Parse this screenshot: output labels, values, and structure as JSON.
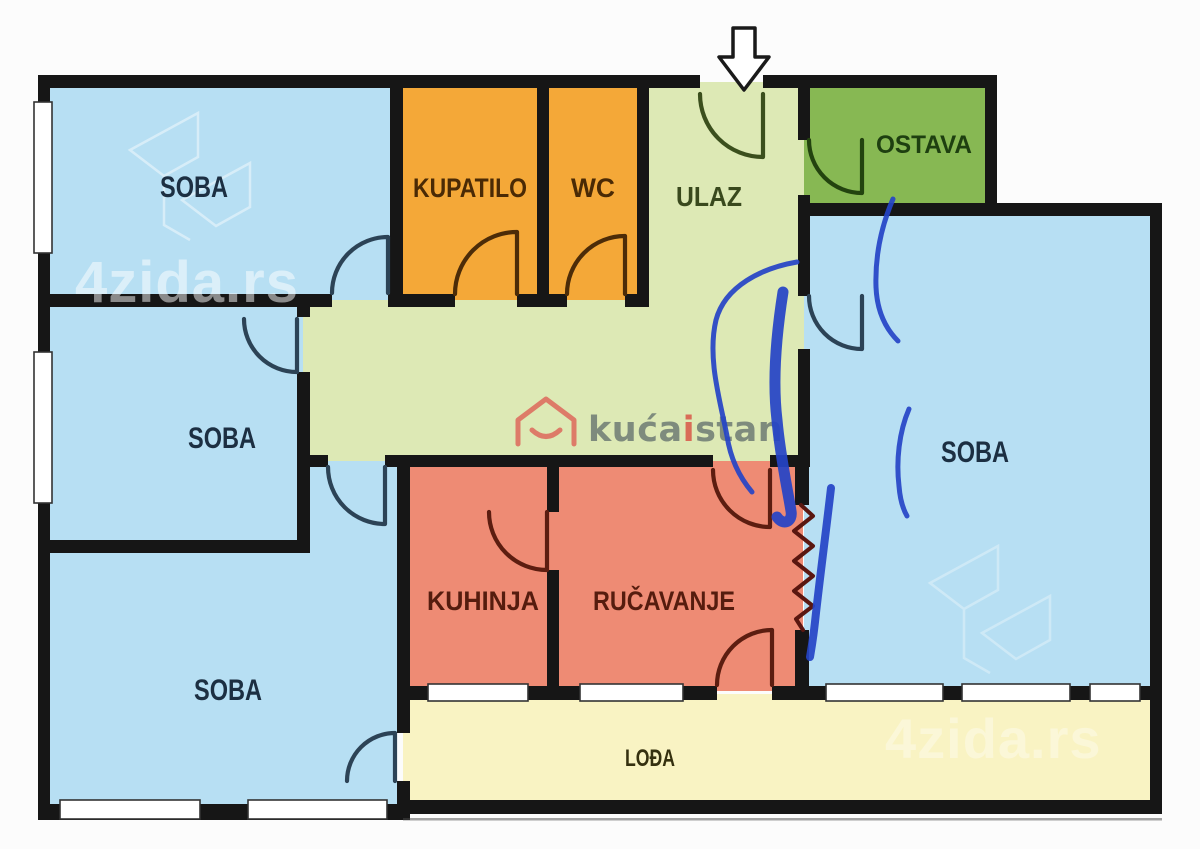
{
  "rooms": {
    "soba_top_left": "SOBA",
    "kupatilo": "KUPATILO",
    "wc": "WC",
    "ulaz": "ULAZ",
    "ostava": "OSTAVA",
    "soba_right": "SOBA",
    "soba_middle_left": "SOBA",
    "soba_bottom_left": "SOBA",
    "kuhinja": "KUHINJA",
    "rucavanje": "RUČAVANJE",
    "lodja": "LOĐA"
  },
  "watermark": {
    "brand_text": "4zida.rs"
  },
  "logo": {
    "part1": "kuća",
    "part2": "i",
    "part3": "stan"
  },
  "colors": {
    "wall": "#161616",
    "bedroom": "#b7dff3",
    "bathroom": "#f4a838",
    "hall": "#dde9b5",
    "storage": "#87b853",
    "kitchen": "#ee8b74",
    "loggia": "#f9f3c3",
    "pen_blue": "#2544c7",
    "radiator": "#5a1710",
    "door_blue": "#2c4356",
    "door_brown": "#4c2c08",
    "door_green": "#3b4f1d",
    "door_dark_green": "#23430f",
    "door_maroon": "#5c1d10",
    "label_soba": "#1c2f42",
    "label_bath": "#4a2a05",
    "label_hall": "#39491d",
    "label_ostava": "#1e3f10",
    "label_kitchen": "#551c0e",
    "label_lodja": "#35300f",
    "logo_house": "#dd7b68",
    "logo_gray": "#7e8b7d",
    "logo_red": "#d96c57"
  }
}
